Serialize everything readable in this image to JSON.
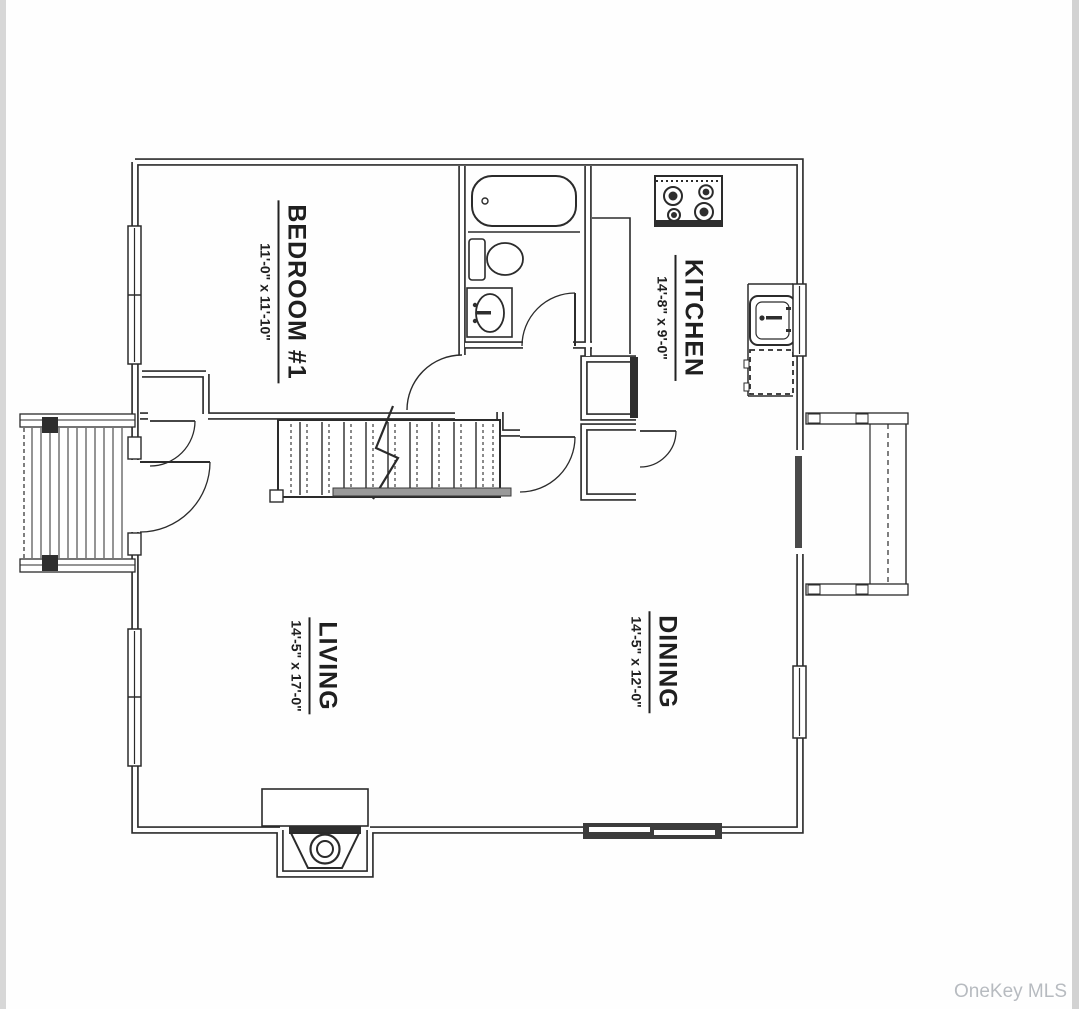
{
  "page": {
    "background": "#fefefe",
    "edge_strip_color": "#d7d7d7",
    "wall_color": "#2b2b2b",
    "handrail_color": "#9a9a9a"
  },
  "watermark": {
    "text": "OneKey MLS",
    "color": "#b7bbc0"
  },
  "rooms": {
    "bedroom": {
      "name": "BEDROOM #1",
      "dims": "11'-0\" x 11'-10\""
    },
    "kitchen": {
      "name": "KITCHEN",
      "dims": "14'-8\" x 9'-0\""
    },
    "living": {
      "name": "LIVING",
      "dims": "14'-5\" x 17'-0\""
    },
    "dining": {
      "name": "DINING",
      "dims": "14'-5\" x 12'-0\""
    }
  },
  "fixtures": [
    "bathtub",
    "toilet",
    "bathroom-sink",
    "stove",
    "kitchen-sink",
    "dishwasher",
    "staircase",
    "handrail",
    "fireplace",
    "left-deck-stairs",
    "right-deck",
    "entry-door",
    "sliding-glass-door",
    "bedroom-window",
    "living-room-window",
    "kitchen-window",
    "dining-window",
    "bedroom-closet",
    "hall-closets"
  ]
}
